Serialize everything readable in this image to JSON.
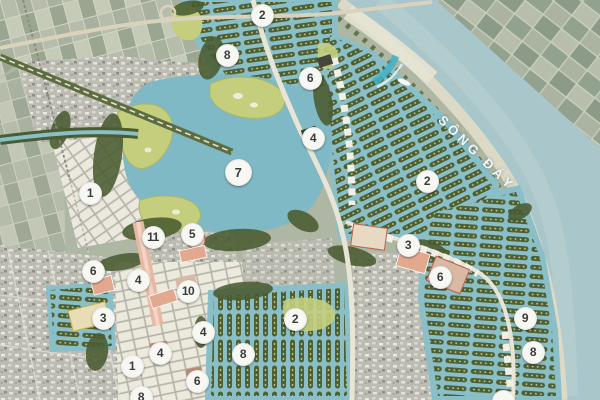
{
  "map": {
    "river_label": "SÔNG ĐÁY",
    "colors": {
      "satellite_base": "#aeb6a4",
      "river_water": "#a9c6ca",
      "canal_water": "#8abfc8",
      "lake_water": "#7fb9c5",
      "beach_sand": "#dcd9c6",
      "golf_green": "#c5ce7d",
      "tree_dark": "#4a5c31",
      "residential_row": "#4d6032",
      "town_gray": "#bdbcb3",
      "planned_block_white": "#ebe9dd",
      "road_white": "#e8e5d6",
      "boulevard_salmon": "#e7b9a4",
      "marker_bg": "#f7f7f3",
      "marker_text": "#3b3b3b"
    },
    "markers": [
      {
        "label": "2",
        "x": 262,
        "y": 15
      },
      {
        "label": "8",
        "x": 227,
        "y": 55
      },
      {
        "label": "6",
        "x": 310,
        "y": 78
      },
      {
        "label": "4",
        "x": 313,
        "y": 138
      },
      {
        "label": "7",
        "x": 238,
        "y": 172,
        "large": true
      },
      {
        "label": "2",
        "x": 427,
        "y": 181
      },
      {
        "label": "1",
        "x": 90,
        "y": 193
      },
      {
        "label": "5",
        "x": 192,
        "y": 234
      },
      {
        "label": "11",
        "x": 153,
        "y": 237
      },
      {
        "label": "3",
        "x": 408,
        "y": 245
      },
      {
        "label": "6",
        "x": 93,
        "y": 271
      },
      {
        "label": "6",
        "x": 440,
        "y": 277
      },
      {
        "label": "4",
        "x": 138,
        "y": 280
      },
      {
        "label": "10",
        "x": 188,
        "y": 291
      },
      {
        "label": "3",
        "x": 103,
        "y": 318
      },
      {
        "label": "2",
        "x": 295,
        "y": 319
      },
      {
        "label": "9",
        "x": 525,
        "y": 318
      },
      {
        "label": "4",
        "x": 203,
        "y": 332
      },
      {
        "label": "8",
        "x": 533,
        "y": 352
      },
      {
        "label": "4",
        "x": 160,
        "y": 353
      },
      {
        "label": "8",
        "x": 243,
        "y": 354
      },
      {
        "label": "1",
        "x": 132,
        "y": 366
      },
      {
        "label": "6",
        "x": 197,
        "y": 381
      },
      {
        "label": "8",
        "x": 141,
        "y": 397
      },
      {
        "label": "",
        "x": 503,
        "y": 401
      }
    ]
  }
}
